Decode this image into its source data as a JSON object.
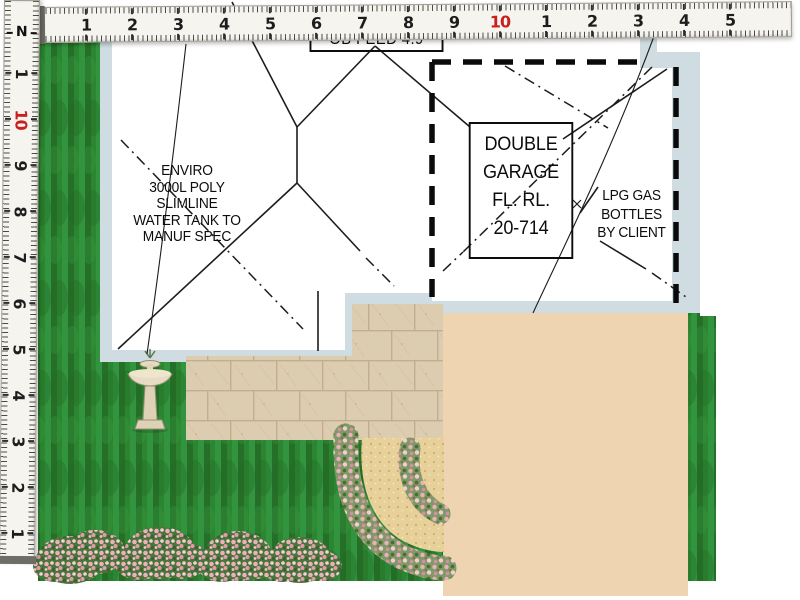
{
  "plan": {
    "annotations": {
      "feed_label": {
        "text": "OB FEED 4.9"
      },
      "water_tank_note": {
        "lines": [
          "ENVIRO",
          "3000L POLY",
          "SLIMLINE",
          "WATER TANK TO",
          "MANUF SPEC"
        ]
      },
      "garage_label": {
        "lines": [
          "DOUBLE",
          "GARAGE",
          "FL. RL.",
          "20-714"
        ]
      },
      "lpg_note": {
        "lines": [
          "LPG GAS",
          "BOTTLES",
          "BY CLIENT"
        ]
      },
      "north_marker": "N"
    },
    "colors": {
      "grass": "#2c8530",
      "wall_band": "#cfdde2",
      "paver": "#ddcdb0",
      "deck_tan": "#eed4b0",
      "sand_path": "#e7d099",
      "flower_pink": "#eeafbd",
      "line_black": "#1c1c1c",
      "ruler_red": "#c8201d"
    }
  },
  "rulers": {
    "horizontal": {
      "numbers": [
        {
          "x": 85,
          "label": "1"
        },
        {
          "x": 131,
          "label": "2"
        },
        {
          "x": 177,
          "label": "3"
        },
        {
          "x": 223,
          "label": "4"
        },
        {
          "x": 269,
          "label": "5"
        },
        {
          "x": 315,
          "label": "6"
        },
        {
          "x": 361,
          "label": "7"
        },
        {
          "x": 407,
          "label": "8"
        },
        {
          "x": 453,
          "label": "9"
        },
        {
          "x": 499,
          "label": "10",
          "red": true
        },
        {
          "x": 545,
          "label": "1"
        },
        {
          "x": 591,
          "label": "2"
        },
        {
          "x": 637,
          "label": "3"
        },
        {
          "x": 683,
          "label": "4"
        },
        {
          "x": 729,
          "label": "5"
        }
      ]
    },
    "vertical": {
      "numbers": [
        {
          "y": 532,
          "label": "1"
        },
        {
          "y": 486,
          "label": "2"
        },
        {
          "y": 440,
          "label": "3"
        },
        {
          "y": 394,
          "label": "4"
        },
        {
          "y": 348,
          "label": "5"
        },
        {
          "y": 302,
          "label": "6"
        },
        {
          "y": 256,
          "label": "7"
        },
        {
          "y": 210,
          "label": "8"
        },
        {
          "y": 164,
          "label": "9"
        },
        {
          "y": 118,
          "label": "10",
          "red": true
        },
        {
          "y": 72,
          "label": "1"
        }
      ]
    }
  }
}
